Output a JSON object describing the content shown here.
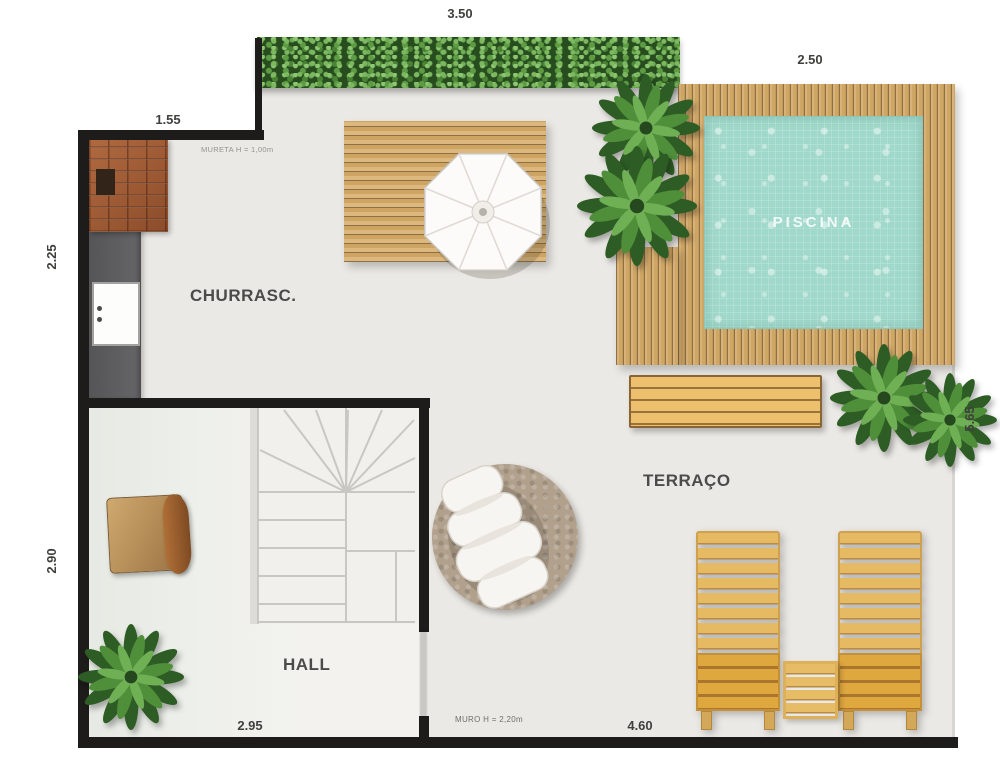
{
  "rooms": {
    "piscina": {
      "label": "PISCINA"
    },
    "churrasco": {
      "label": "CHURRASC."
    },
    "terraco": {
      "label": "TERRAÇO"
    },
    "hall": {
      "label": "HALL"
    }
  },
  "dimensions": {
    "hedge_width": "3.50",
    "pool_width": "2.50",
    "entry_width": "1.55",
    "churrasco_height": "2.25",
    "hall_height": "2.90",
    "terrace_height": "5.65",
    "hall_width": "2.95",
    "terrace_width": "4.60"
  },
  "notes": {
    "parapet": "MURETA H = 1,00m",
    "wall": "MURO H = 2,20m"
  },
  "colors": {
    "wall": "#1d1c1a",
    "floor": "#ebe9e5",
    "pool_water": "#a0d8cb",
    "deck_wood": "#d8b27a",
    "hedge": "#274d1f",
    "counter": "#58585a",
    "lounger_wood": "#e6ba62",
    "rug": "#b1a08c",
    "label_text": "#4b4b49"
  }
}
